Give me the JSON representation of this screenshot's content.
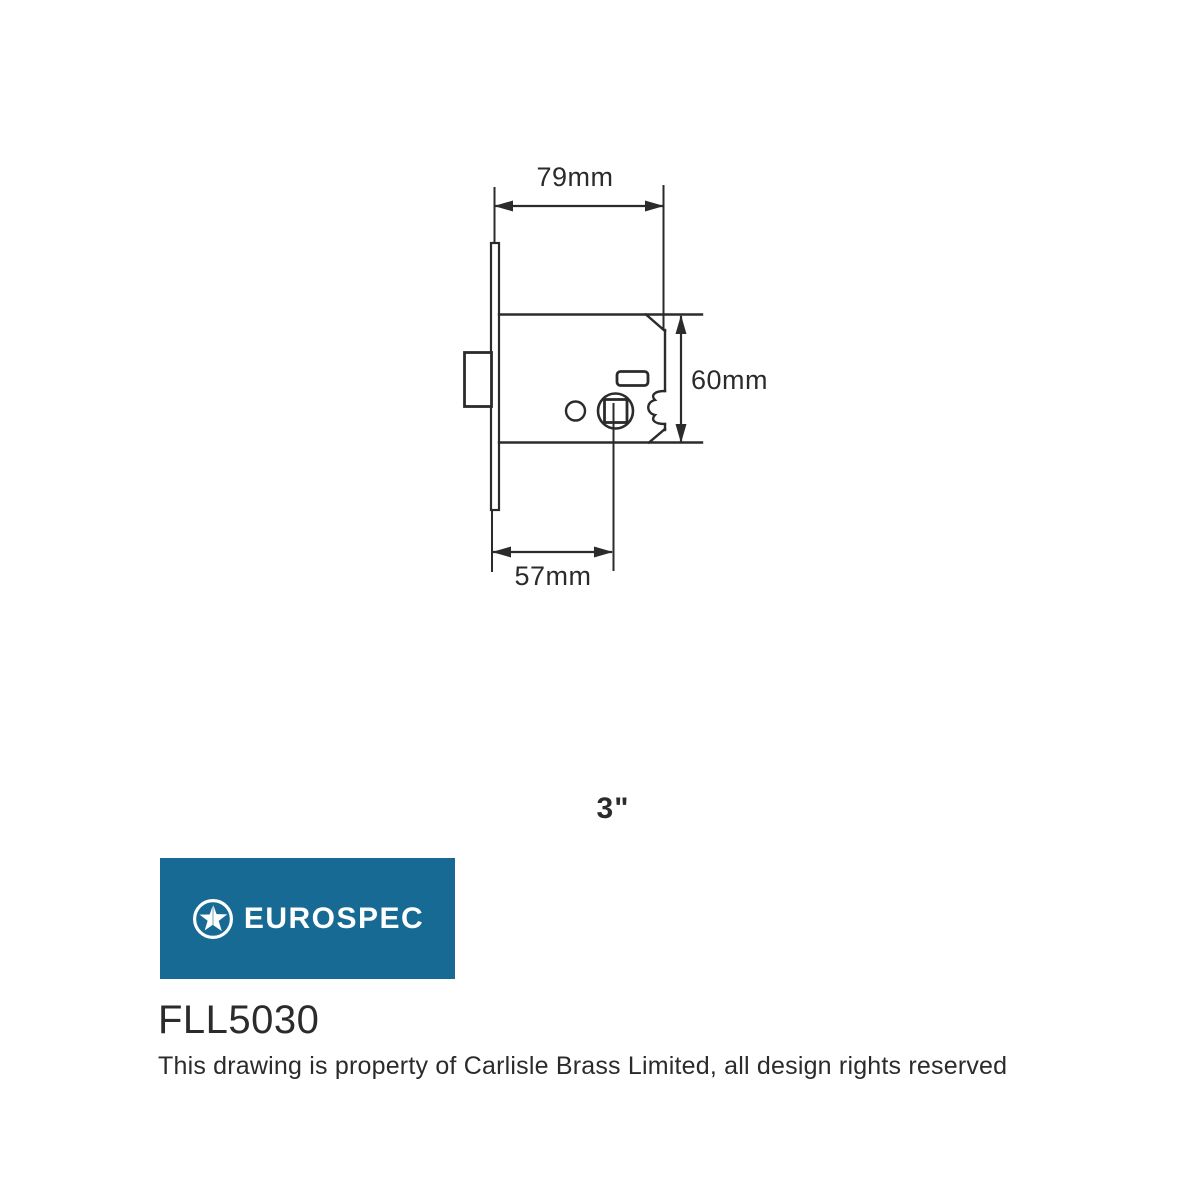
{
  "document": {
    "type": "technical-drawing",
    "background_color": "#ffffff",
    "line_color": "#2b2b2b"
  },
  "drawing": {
    "subject": "mortice latch side view",
    "dimensions": {
      "case_width": "79mm",
      "case_height": "60mm",
      "backset": "57mm"
    },
    "size_label": "3\"",
    "parts": [
      "faceplate",
      "latch-bolt",
      "lock-case",
      "follower-spindle-hole",
      "fixing-hole",
      "slot"
    ]
  },
  "brand": {
    "name": "EUROSPEC",
    "logo_icon": "star-in-circle-icon",
    "background_color": "#176a94",
    "text_color": "#ffffff"
  },
  "product": {
    "code": "FLL5030",
    "rights_notice": "This drawing is property of Carlisle Brass Limited, all design rights reserved"
  }
}
